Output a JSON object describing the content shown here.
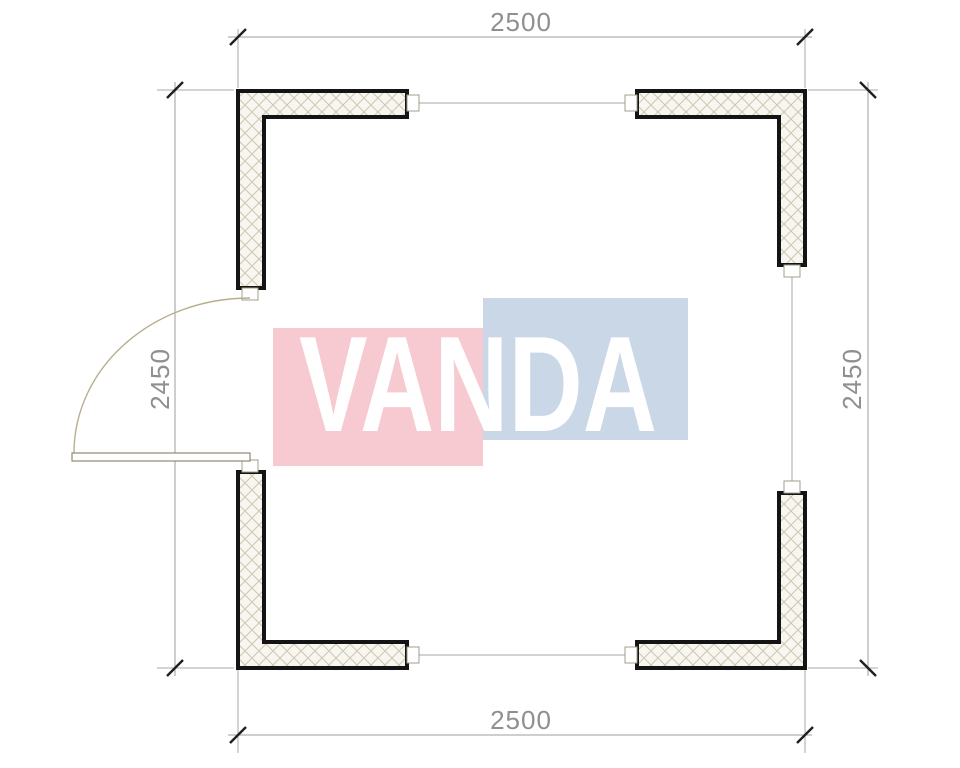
{
  "drawing": {
    "dimensions": {
      "top": "2500",
      "bottom": "2500",
      "left": "2450",
      "right": "2450"
    },
    "watermark": {
      "text": "VANDA",
      "pink_color": "#f7c9d1",
      "blue_color": "#cad7e7",
      "text_color": "#ffffff"
    },
    "colors": {
      "wall_outline": "#141414",
      "wall_fill": "#f8f6f0",
      "hatch_line": "#cfc8b4",
      "dimension_line": "#9c9c9c",
      "dimension_text": "#8f8f8f",
      "tick": "#1f1f1f",
      "door_arc": "#b8ad8e",
      "connector_line": "#b6b6b6"
    }
  }
}
